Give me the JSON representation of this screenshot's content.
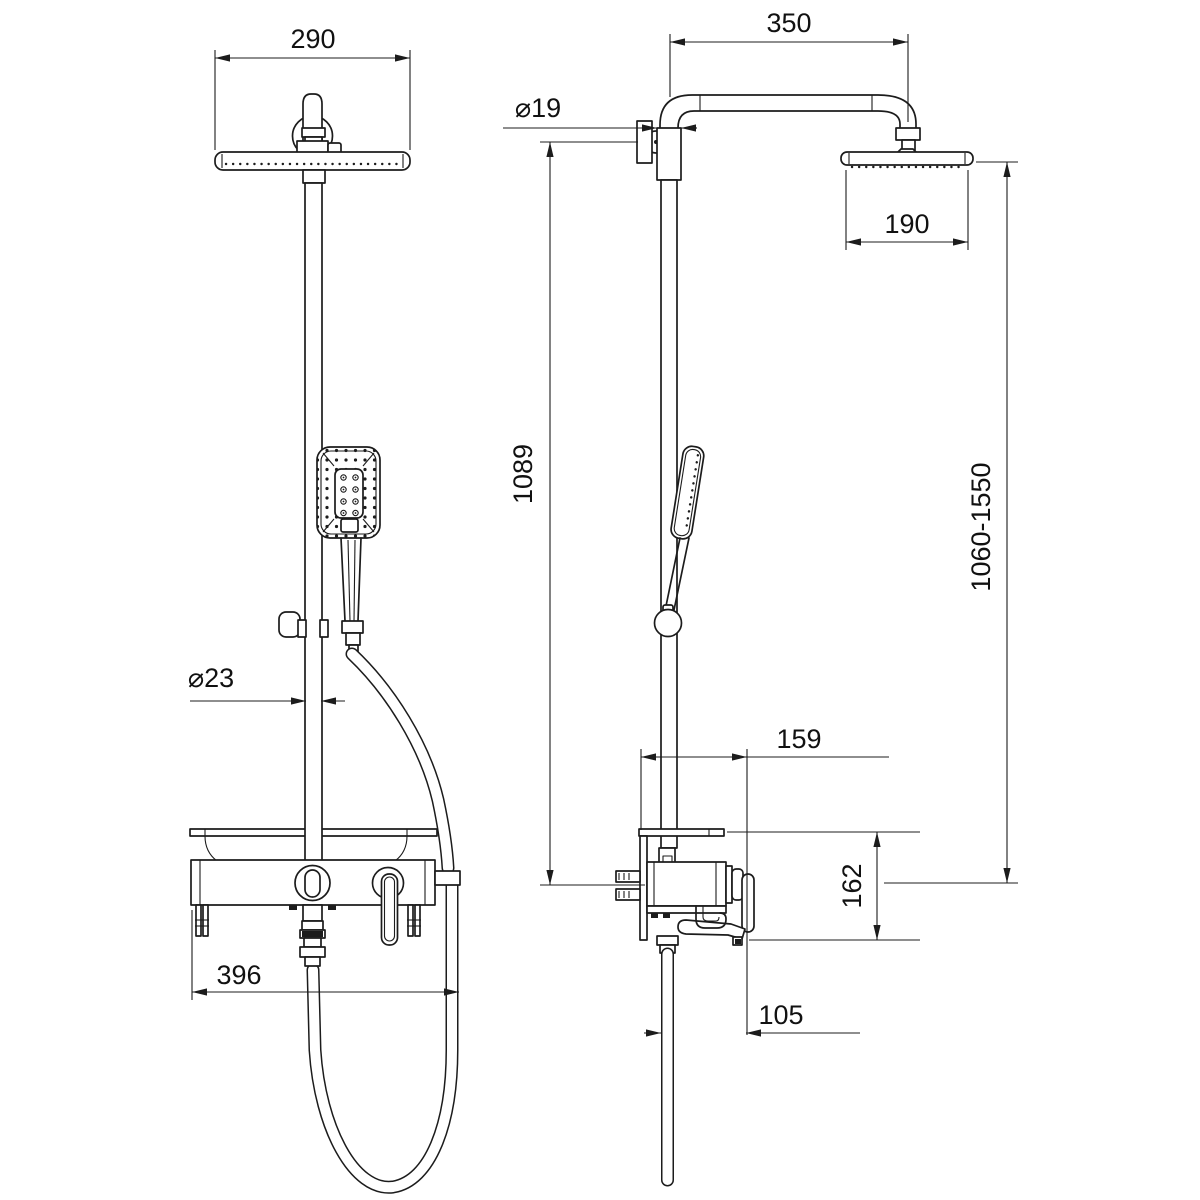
{
  "colors": {
    "background": "#ffffff",
    "line": "#1c1c1c"
  },
  "front_view": {
    "dims": {
      "head_width": "290",
      "column_pipe_diameter": "⌀23",
      "mixer_width": "396"
    }
  },
  "side_view": {
    "dims": {
      "arm_reach": "350",
      "wall_pipe_diameter": "⌀19",
      "head_diameter": "190",
      "bracket_to_mixer_height": "1089",
      "overall_height_range": "1060-1550",
      "shelf_depth": "159",
      "mixer_height": "162",
      "spout_offset": "105"
    }
  }
}
